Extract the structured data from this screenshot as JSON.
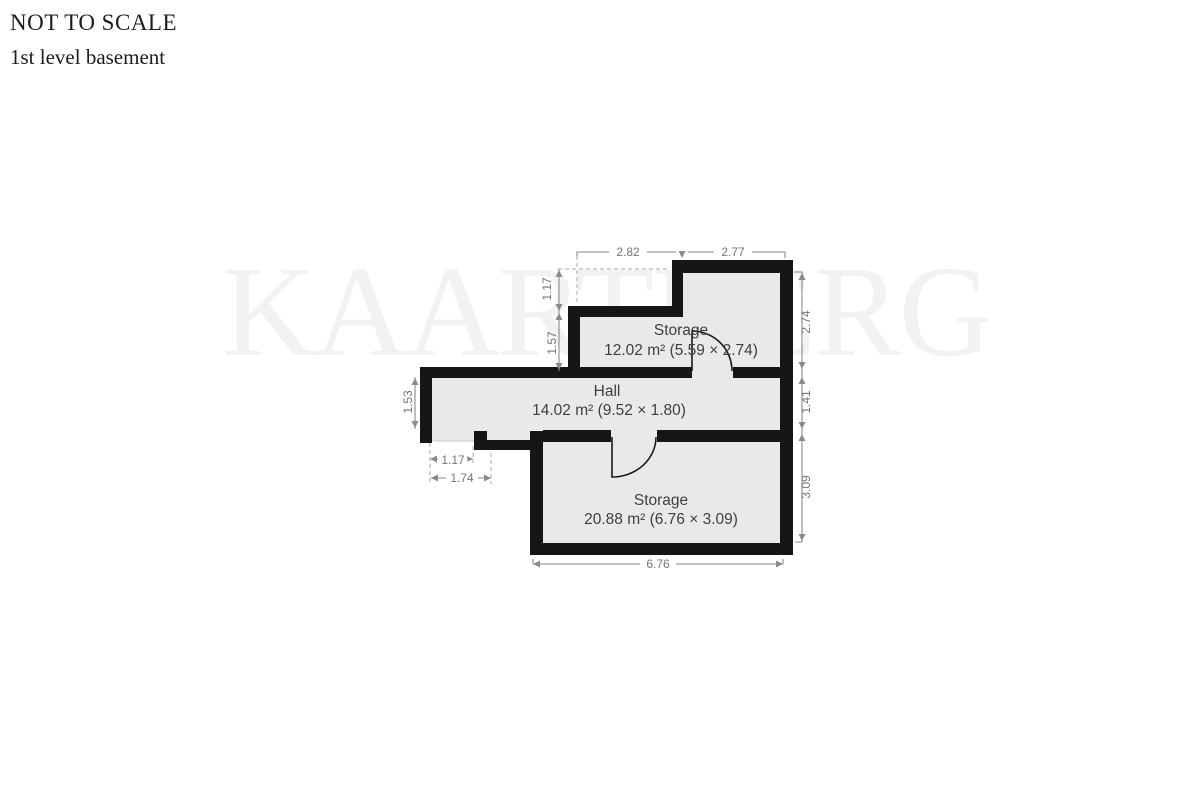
{
  "header": {
    "line1": "NOT TO SCALE",
    "line2": "1st level basement"
  },
  "watermark": {
    "text": "KAARTBERG"
  },
  "rooms": [
    {
      "name": "Storage",
      "area": "12.02 m² (5.59 × 2.74)"
    },
    {
      "name": "Hall",
      "area": "14.02 m² (9.52 × 1.80)"
    },
    {
      "name": "Storage",
      "area": "20.88 m² (6.76 × 3.09)"
    }
  ],
  "dimensions": {
    "top_left": "2.82",
    "top_right": "2.77",
    "left_upper": "1.17",
    "left_mid": "1.57",
    "left_hall": "1.53",
    "right_upper": "2.74",
    "right_mid": "1.41",
    "right_lower": "3.09",
    "notch_inner": "1.17",
    "notch_outer": "1.74",
    "bottom": "6.76"
  },
  "colors": {
    "wall": "#161616",
    "room_fill": "#e9e9eb",
    "dim": "#8a8a8a",
    "dim_text": "#757575",
    "room_text": "#3f3f3f",
    "title_text": "#1c1c1c",
    "watermark": "#f2f2f2",
    "page_bg": "#ffffff"
  }
}
